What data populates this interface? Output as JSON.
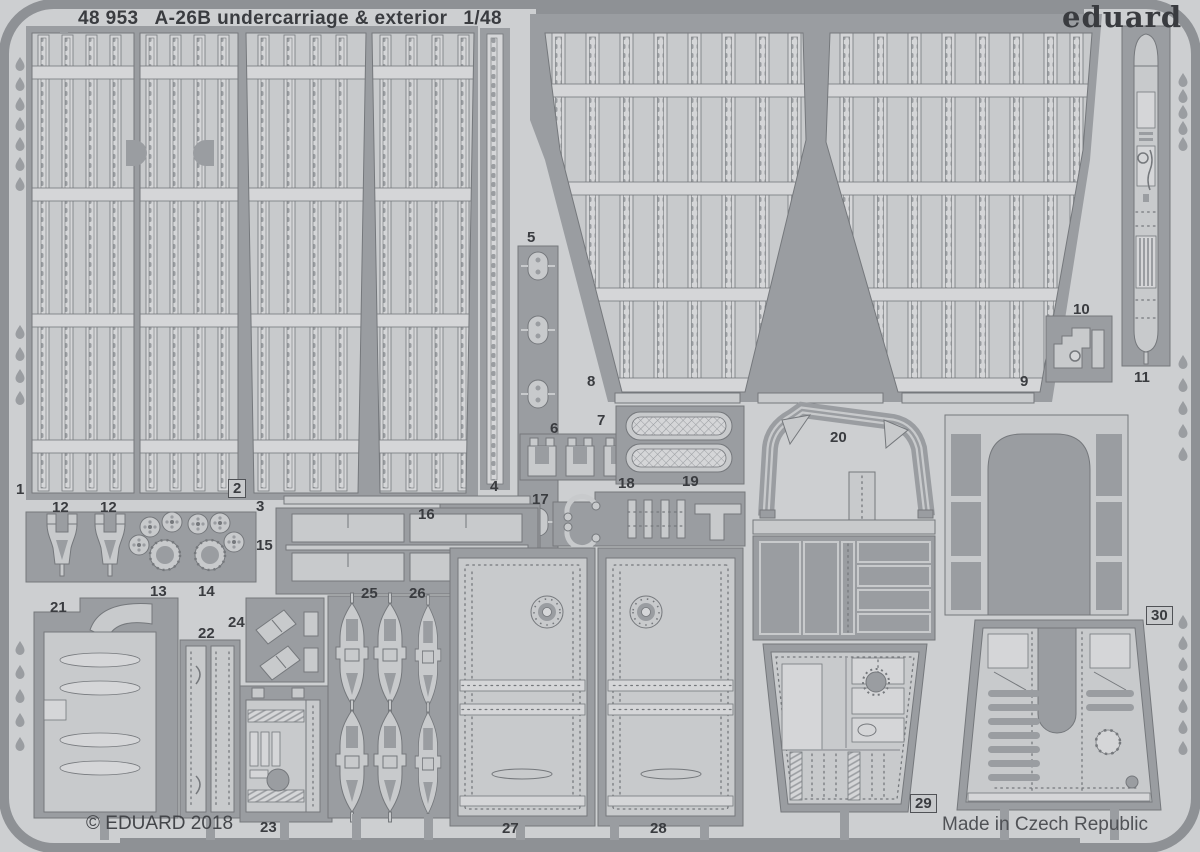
{
  "header": {
    "catalog_number": "48 953",
    "title": "A-26B undercarriage & exterior",
    "scale": "1/48",
    "brand": "eduard"
  },
  "footer": {
    "copyright": "© EDUARD 2018",
    "made_in": "Made in Czech Republic"
  },
  "colors": {
    "bg": "#cdcfd1",
    "frame": "#9a9da1",
    "framedark": "#8e9195",
    "light": "#c8cacc",
    "lighter": "#d5d6d8",
    "line": "#75787c",
    "text": "#3a3c40"
  },
  "part_labels": [
    {
      "text": "1",
      "x": 16,
      "y": 482,
      "boxed": false
    },
    {
      "text": "2",
      "x": 228,
      "y": 479,
      "boxed": true
    },
    {
      "text": "3",
      "x": 256,
      "y": 499,
      "boxed": false
    },
    {
      "text": "4",
      "x": 490,
      "y": 479,
      "boxed": false
    },
    {
      "text": "5",
      "x": 527,
      "y": 230,
      "boxed": false
    },
    {
      "text": "6",
      "x": 550,
      "y": 421,
      "boxed": false
    },
    {
      "text": "7",
      "x": 597,
      "y": 413,
      "boxed": false
    },
    {
      "text": "8",
      "x": 587,
      "y": 374,
      "boxed": false
    },
    {
      "text": "9",
      "x": 1020,
      "y": 374,
      "boxed": false
    },
    {
      "text": "10",
      "x": 1073,
      "y": 302,
      "boxed": false
    },
    {
      "text": "11",
      "x": 1134,
      "y": 370,
      "boxed": false
    },
    {
      "text": "12",
      "x": 52,
      "y": 500,
      "boxed": false
    },
    {
      "text": "12",
      "x": 100,
      "y": 500,
      "boxed": false
    },
    {
      "text": "13",
      "x": 150,
      "y": 584,
      "boxed": false
    },
    {
      "text": "14",
      "x": 198,
      "y": 584,
      "boxed": false
    },
    {
      "text": "15",
      "x": 256,
      "y": 538,
      "boxed": false
    },
    {
      "text": "16",
      "x": 418,
      "y": 507,
      "boxed": false
    },
    {
      "text": "17",
      "x": 532,
      "y": 492,
      "boxed": false
    },
    {
      "text": "18",
      "x": 618,
      "y": 476,
      "boxed": false
    },
    {
      "text": "19",
      "x": 682,
      "y": 474,
      "boxed": false
    },
    {
      "text": "20",
      "x": 830,
      "y": 430,
      "boxed": false
    },
    {
      "text": "21",
      "x": 50,
      "y": 600,
      "boxed": false
    },
    {
      "text": "22",
      "x": 198,
      "y": 626,
      "boxed": false
    },
    {
      "text": "23",
      "x": 260,
      "y": 820,
      "boxed": false
    },
    {
      "text": "24",
      "x": 228,
      "y": 615,
      "boxed": false
    },
    {
      "text": "25",
      "x": 361,
      "y": 586,
      "boxed": false
    },
    {
      "text": "26",
      "x": 409,
      "y": 586,
      "boxed": false
    },
    {
      "text": "27",
      "x": 502,
      "y": 821,
      "boxed": false
    },
    {
      "text": "28",
      "x": 650,
      "y": 821,
      "boxed": false
    },
    {
      "text": "29",
      "x": 910,
      "y": 794,
      "boxed": true
    },
    {
      "text": "30",
      "x": 1146,
      "y": 606,
      "boxed": true
    }
  ]
}
